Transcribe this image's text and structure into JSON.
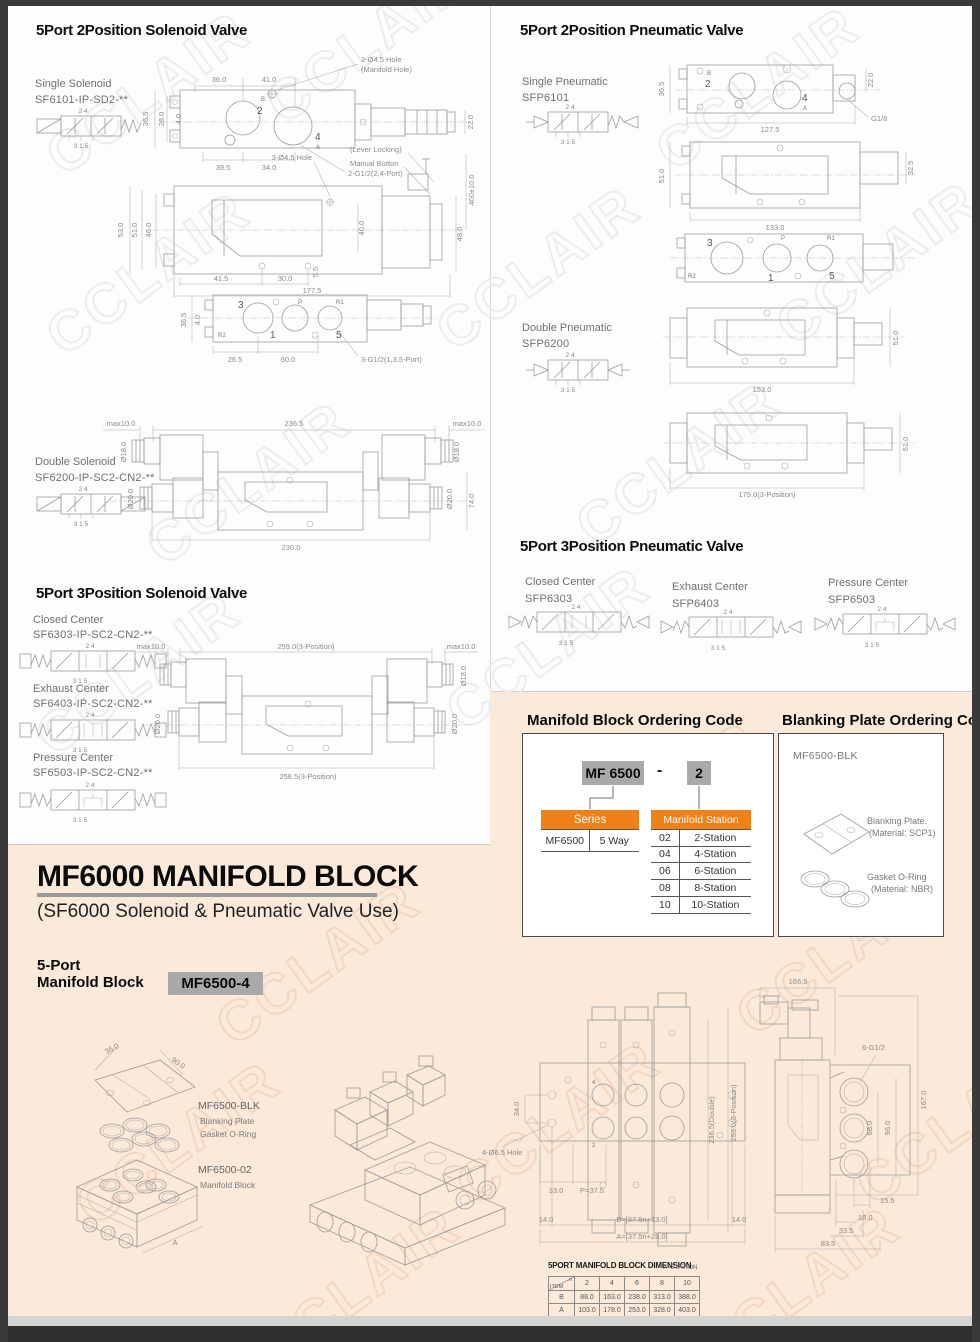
{
  "watermark": {
    "text": "CCLAIR"
  },
  "colors": {
    "accent_orange": "#F08018",
    "peach_bg": "#FBE9D9",
    "chip_gray": "#A9A9A9",
    "panel_white": "#FFFFFF"
  },
  "sym": {
    "top": "2  4",
    "bottom": "3 1 5"
  },
  "s2sv": {
    "title": "5Port 2Position Solenoid Valve",
    "single_label": "Single Solenoid",
    "single_model": "SF6101-IP-SD2-**",
    "double_label": "Double Solenoid",
    "double_model": "SF6200-IP-SC2-CN2-**",
    "d1": {
      "dim_top1": "36.0",
      "dim_top2": "41.0",
      "hole": "2-Ø4.5 Hole",
      "hole2": "(Manifold Hole)",
      "h1": "36.5",
      "h2": "28.0",
      "h3": "4.0",
      "port_b": "B",
      "port_2": "2",
      "port_4": "4",
      "port_a": "A",
      "r1": "22.0",
      "b1": "39.5",
      "b2": "34.0",
      "note": "2-G1/2(2,4-Port)"
    },
    "d2": {
      "hole": "3-Ø4.5 Hole",
      "lever": "(Lever Locking)",
      "manual": "Manual Button",
      "wire": "400±10.0",
      "h1": "53.0",
      "h2": "51.0",
      "h3": "46.0",
      "h4": "40.0",
      "r1": "48.0",
      "b1": "41.5",
      "b2": "30.0",
      "b3": "5.5",
      "b4": "177.5"
    },
    "d3": {
      "p3": "3",
      "pp": "P",
      "pr1": "R1",
      "pr2": "R2",
      "p1": "1",
      "p5": "5",
      "h1": "36.5",
      "h2": "4.0",
      "b1": "26.5",
      "b2": "60.0",
      "note": "3-G1/2(1,3,5-Port)"
    },
    "d4": {
      "t1": "max10.0",
      "t2": "236.5",
      "t3": "max10.0",
      "l1": "Ø18.0",
      "r1": "Ø18.0",
      "l2": "Ø20.0",
      "r2": "Ø20.0",
      "r3": "74.0",
      "b1": "230.0"
    }
  },
  "s3sv": {
    "title": "5Port 3Position Solenoid Valve",
    "variants": [
      {
        "label": "Closed Center",
        "model": "SF6303-IP-SC2-CN2-**"
      },
      {
        "label": "Exhaust Center",
        "model": "SF6403-IP-SC2-CN2-**"
      },
      {
        "label": "Pressure Center",
        "model": "SF6503-IP-SC2-CN2-**"
      }
    ],
    "d5": {
      "t1": "max10.0",
      "t2": "259.0(3-Position)",
      "t3": "max10.0",
      "r1": "Ø18.0",
      "l2": "Ø20.0",
      "r2": "Ø20.0",
      "b1": "258.5(3-Position)"
    }
  },
  "s2pv": {
    "title": "5Port 2Position Pneumatic Valve",
    "single_label": "Single Pneumatic",
    "single_model": "SFP6101",
    "double_label": "Double Pneumatic",
    "double_model": "SFP6200",
    "d1": {
      "port_b": "B",
      "port_2": "2",
      "port_4": "4",
      "port_a": "A",
      "h1": "36.5",
      "r1": "22.0",
      "thread": "G1/8",
      "b1": "127.5"
    },
    "d2": {
      "h1": "51.0",
      "r1": "32.5",
      "b1": "133.0"
    },
    "d3": {
      "p3": "3",
      "pp": "P",
      "pr1": "R1",
      "pr2": "R2",
      "p1": "1",
      "p5": "5"
    },
    "d4": {
      "r1": "51.0",
      "b1": "153.0"
    },
    "d5": {
      "r1": "51.0",
      "b1": "179.0(3-Position)"
    }
  },
  "s3pv": {
    "title": "5Port 3Position Pneumatic Valve",
    "variants": [
      {
        "label": "Closed Center",
        "model": "SFP6303"
      },
      {
        "label": "Exhaust Center",
        "model": "SFP6403"
      },
      {
        "label": "Pressure Center",
        "model": "SFP6503"
      }
    ]
  },
  "ordering": {
    "title": "Manifold Block Ordering  Code",
    "code_series": "MF 6500",
    "code_dash": "-",
    "code_station": "2",
    "series_header": "Series",
    "series_code": "MF6500",
    "series_desc": "5 Way",
    "station_header": "Manifold Station",
    "station_rows": [
      {
        "code": "02",
        "desc": "2-Station"
      },
      {
        "code": "04",
        "desc": "4-Station"
      },
      {
        "code": "06",
        "desc": "6-Station"
      },
      {
        "code": "08",
        "desc": "8-Station"
      },
      {
        "code": "10",
        "desc": "10-Station"
      }
    ]
  },
  "blanking": {
    "title": "Blanking Plate Ordering  Code",
    "model": "MF6500-BLK",
    "plate_label": "Blanking Plate.",
    "plate_material": "(Material: SCP1)",
    "oring_label": "Gasket O-Ring",
    "oring_material": "(Material: NBR)"
  },
  "mf6000": {
    "title": "MF6000 MANIFOLD BLOCK",
    "subtitle": "(SF6000 Solenoid & Pneumatic Valve Use)",
    "block_line1": "5-Port",
    "block_line2": "Manifold Block",
    "block_code": "MF6500-4",
    "exploded": {
      "dim1": "36.0",
      "dim2": "90.0",
      "blk_model": "MF6500-BLK",
      "blk_l1": "Blanking Plate",
      "blk_l2": "Gasket O-Ring",
      "mb_model": "MF6500-02",
      "mb_label": "Manifold Block",
      "dimA": "A"
    },
    "topview": {
      "l1": "34.0",
      "hole": "4-Ø6.5 Hole",
      "b1": "33.0",
      "b2": "P=37.5",
      "r1": "236.5(Double)",
      "r2": "259.0(3-Position)",
      "f1": "14.0",
      "f2": "B=[37.5n+13.0]",
      "f3": "14.0",
      "f4": "A=[37.5n+28.0]",
      "p4": "4",
      "p2": "2"
    },
    "sideview": {
      "t1": "166.5",
      "thread": "6-G1/2",
      "r1": "167.0",
      "r2": "96.0",
      "r3": "68.0",
      "b1": "15.5",
      "b2": "18.0",
      "b3": "33.5",
      "b4": "83.5"
    },
    "table": {
      "title": "5PORT MANIFOLD BLOCK DIMENSION",
      "note": "n=STATION",
      "corner_n": "n",
      "corner_item": "ITEM",
      "cols": [
        "2",
        "4",
        "6",
        "8",
        "10"
      ],
      "rows": [
        {
          "item": "B",
          "v": [
            "88.0",
            "163.0",
            "238.0",
            "313.0",
            "388.0"
          ]
        },
        {
          "item": "A",
          "v": [
            "103.0",
            "178.0",
            "253.0",
            "328.0",
            "403.0"
          ]
        }
      ]
    }
  }
}
